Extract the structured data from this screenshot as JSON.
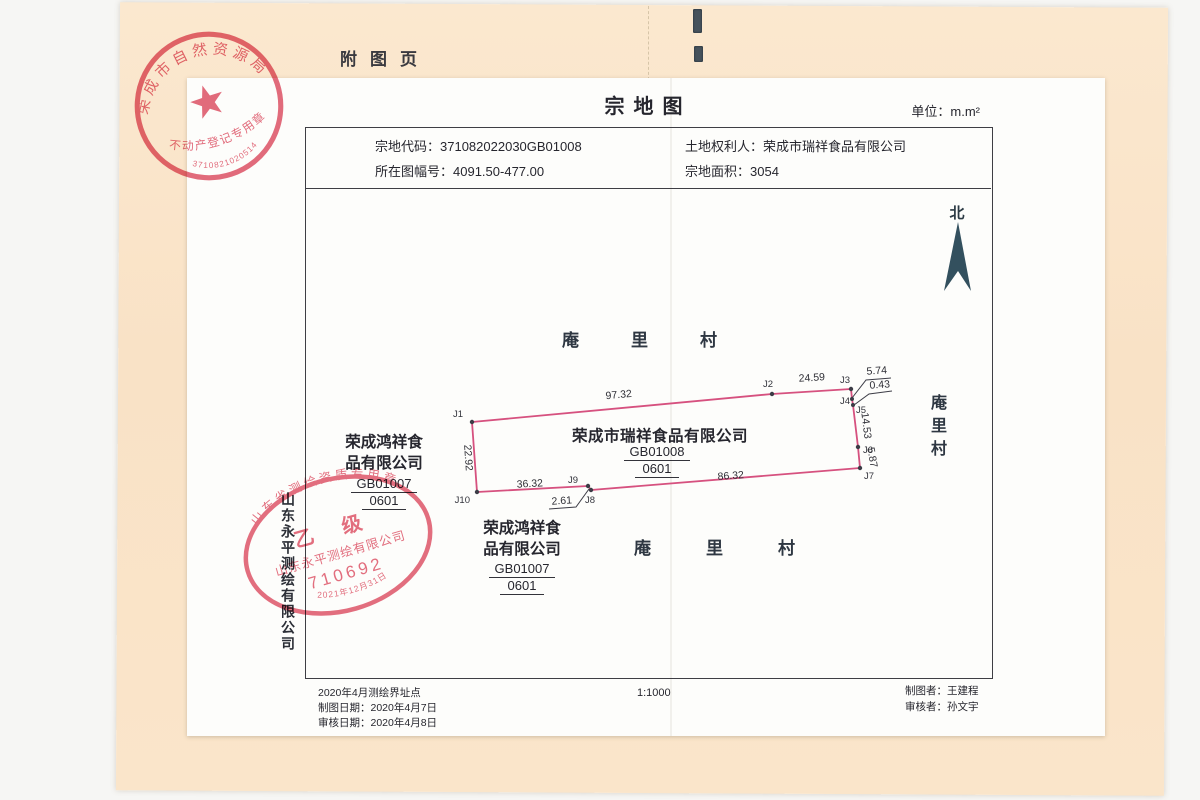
{
  "page": {
    "fold_label": "附图页",
    "title": "宗地图",
    "unit_label": "单位：m.m²"
  },
  "header": {
    "code_label": "宗地代码：",
    "code_value": "371082022030GB01008",
    "sheet_label": "所在图幅号：",
    "sheet_value": "4091.50-477.00",
    "owner_label": "土地权利人：",
    "owner_value": "荣成市瑞祥食品有限公司",
    "area_label": "宗地面积：",
    "area_value": "3054"
  },
  "map": {
    "north_label": "北",
    "village_top": "庵里村",
    "village_bottom": "庵里村",
    "village_right": "庵里村",
    "parcel_owner": "荣成市瑞祥食品有限公司",
    "parcel_code": "GB01008",
    "parcel_subcode": "0601",
    "neighbor_line1": "荣成鸿祥食",
    "neighbor_line2": "品有限公司",
    "neighbor_code": "GB01007",
    "neighbor_subcode": "0601",
    "points": [
      "J1",
      "J2",
      "J3",
      "J4",
      "J5",
      "J6",
      "J7",
      "J8",
      "J9",
      "J10"
    ],
    "distances": {
      "d_j1_j2": "97.32",
      "d_j2_j3": "24.59",
      "d_j3_j4": "5.74",
      "d_j4_j5": "0.43",
      "d_j5_j6": "14.53",
      "d_j6_j7": "5.87",
      "d_j7_j8": "86.32",
      "d_j8_j9": "2.61",
      "d_j9_j10": "36.32",
      "d_j10_j1": "22.92"
    },
    "scale": "1:1000"
  },
  "footer": {
    "survey_note": "2020年4月测绘界址点",
    "draw_date": "制图日期：2020年4月7日",
    "review_date": "审核日期：2020年4月8日",
    "scale": "1:1000",
    "drafter": "制图者：王建程",
    "reviewer": "审核者：孙文宇"
  },
  "stamps": {
    "registry": {
      "org": "荣成市自然资源局",
      "purpose": "不动产登记专用章",
      "number": "3710821020514"
    },
    "survey": {
      "arc_title": "山东省测绘资质专用章",
      "grade": "乙 级",
      "company": "山东永平测绘有限公司",
      "number": "710692",
      "date": "2021年12月31日"
    }
  },
  "side_note": "山东永平测绘有限公司",
  "colors": {
    "boundary": "#d6517f",
    "stamp_red": "#dd4b60",
    "north_arrow": "#33505e"
  }
}
